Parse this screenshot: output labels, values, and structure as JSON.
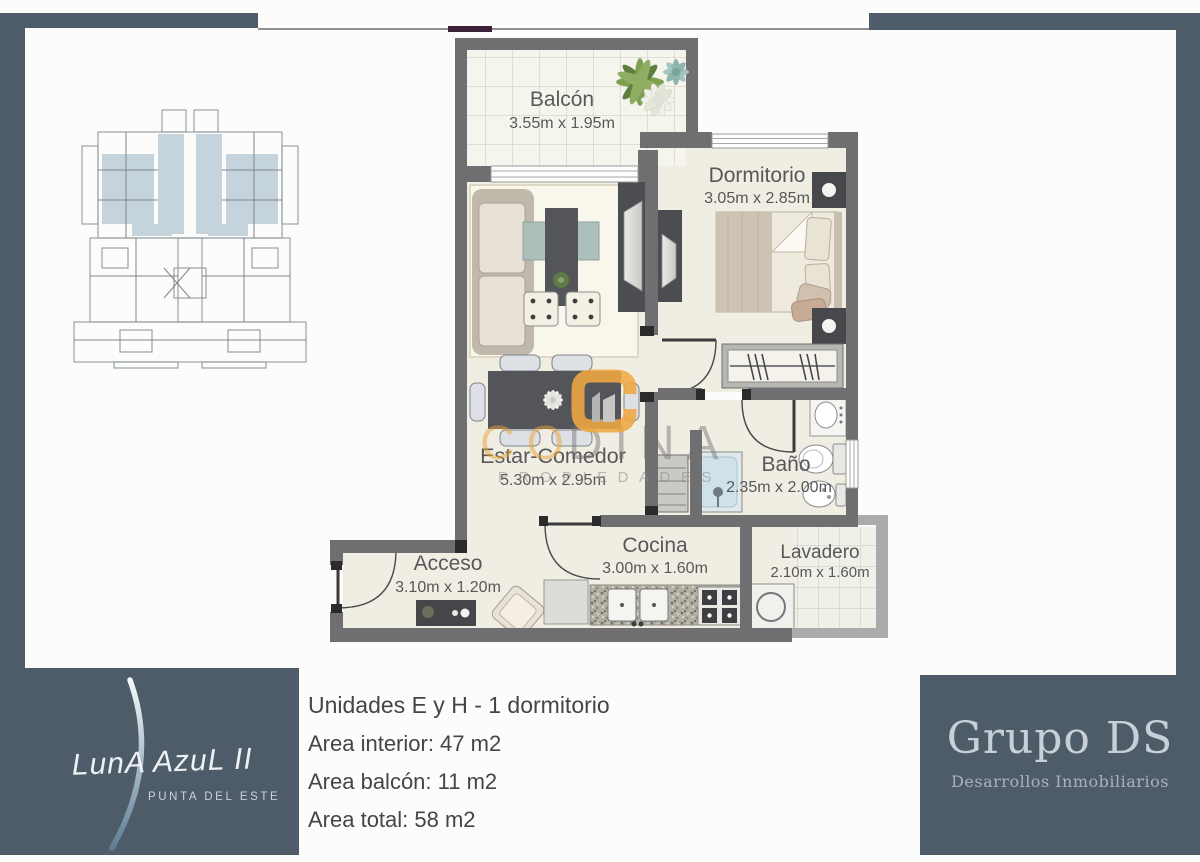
{
  "plan": {
    "rooms": [
      {
        "name": "Balcón",
        "dims": "3.55m x 1.95m"
      },
      {
        "name": "Dormitorio",
        "dims": "3.05m x 2.85m"
      },
      {
        "name": "Estar-Comedor",
        "dims": "5.30m x 2.95m"
      },
      {
        "name": "Baño",
        "dims": "2.35m x 2.00m"
      },
      {
        "name": "Cocina",
        "dims": "3.00m x 1.60m"
      },
      {
        "name": "Lavadero",
        "dims": "2.10m x 1.60m"
      },
      {
        "name": "Acceso",
        "dims": "3.10m x 1.20m"
      }
    ],
    "watermark": {
      "name": "CODINA",
      "name_left": "CO",
      "name_right": "DINA",
      "tagline": "PROPIEDADES"
    }
  },
  "info": {
    "title": "Unidades E y H - 1 dormitorio",
    "area_interior": "Area interior: 47 m2",
    "area_balcon": "Area balcón: 11 m2",
    "area_total": "Area total: 58 m2"
  },
  "brand_left": {
    "wordmark": "LunA AzuL II",
    "subtitle": "PUNTA DEL ESTE"
  },
  "brand_right": {
    "name": "Grupo DS",
    "subtitle": "Desarrollos Inmobiliarios"
  },
  "colors": {
    "slate": "#4d5c68",
    "wall": "#6f6f71",
    "accent_orange": "#f0a843",
    "floor": "#f0ede2",
    "highlight_blue": "#c5d4dc"
  }
}
